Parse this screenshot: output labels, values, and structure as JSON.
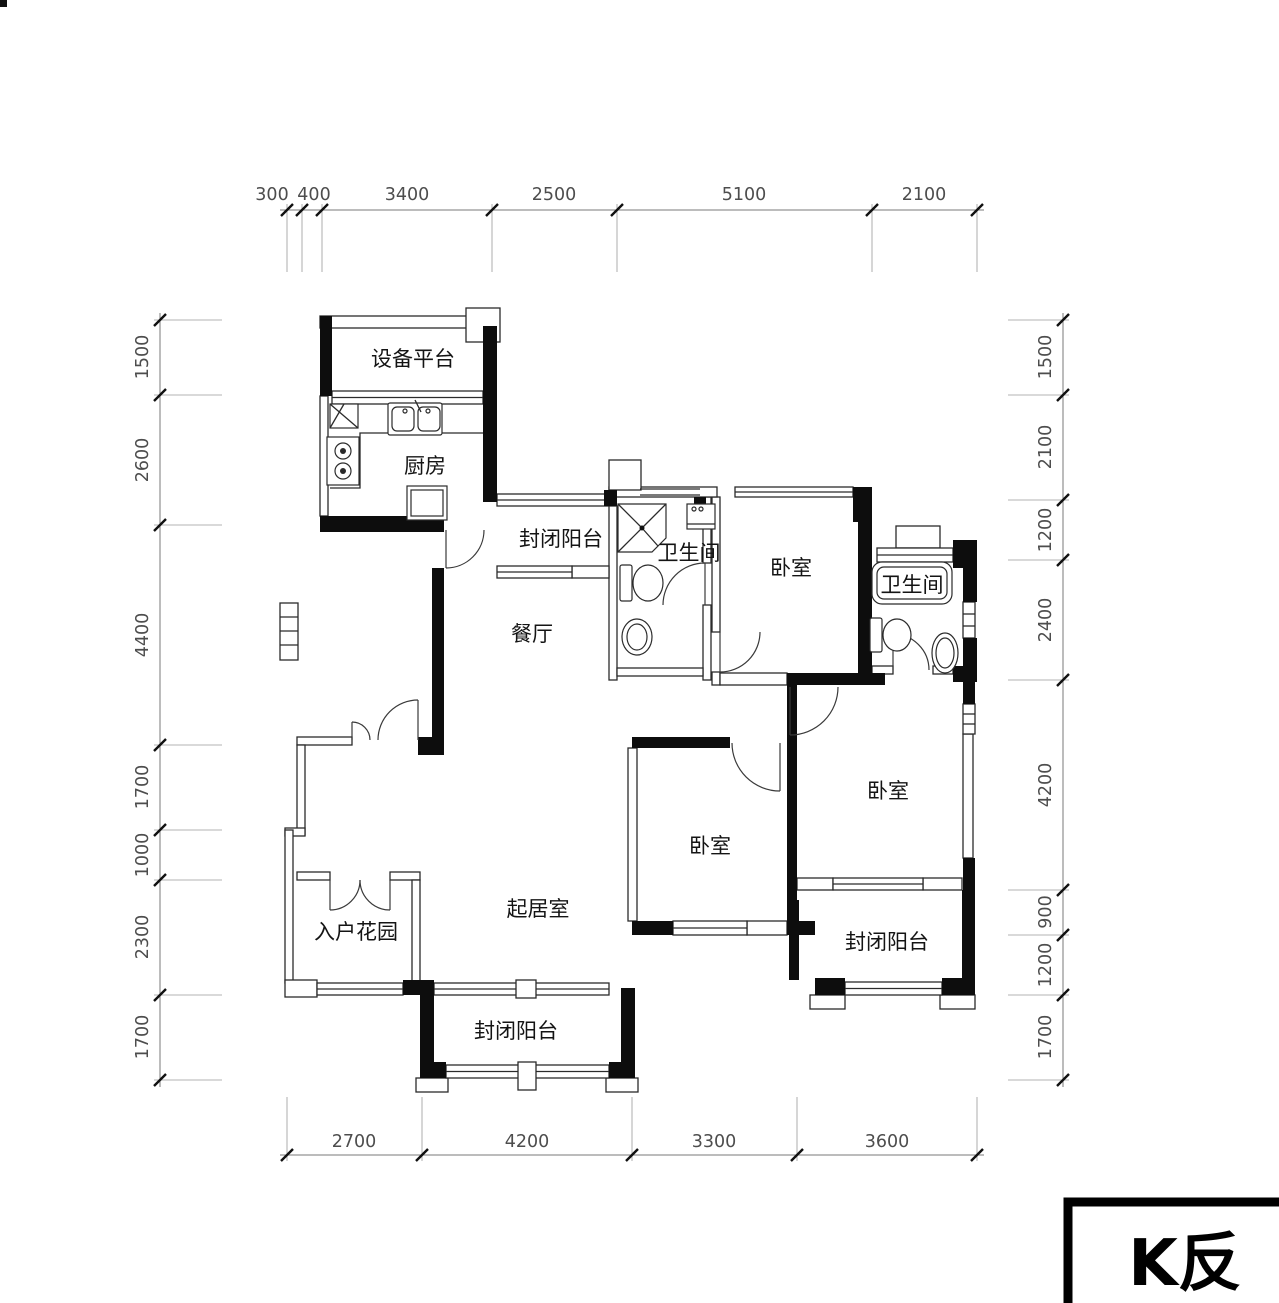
{
  "title_block": {
    "label": "K反"
  },
  "rooms": {
    "equipment_platform": "设备平台",
    "kitchen": "厨房",
    "balcony_top": "封闭阳台",
    "bath_1": "卫生间",
    "bedroom_top": "卧室",
    "bath_2": "卫生间",
    "dining": "餐厅",
    "bedroom_right": "卧室",
    "bedroom_middle": "卧室",
    "living": "起居室",
    "entry_garden": "入户花园",
    "balcony_bottom": "封闭阳台",
    "balcony_right": "封闭阳台"
  },
  "dimensions": {
    "top": [
      "300",
      "400",
      "3400",
      "2500",
      "5100",
      "2100"
    ],
    "bottom": [
      "2700",
      "4200",
      "3300",
      "3600"
    ],
    "left": [
      "1500",
      "2600",
      "4400",
      "1700",
      "1000",
      "2300",
      "1700"
    ],
    "right": [
      "1500",
      "2100",
      "1200",
      "2400",
      "4200",
      "900",
      "1200",
      "1700"
    ]
  }
}
